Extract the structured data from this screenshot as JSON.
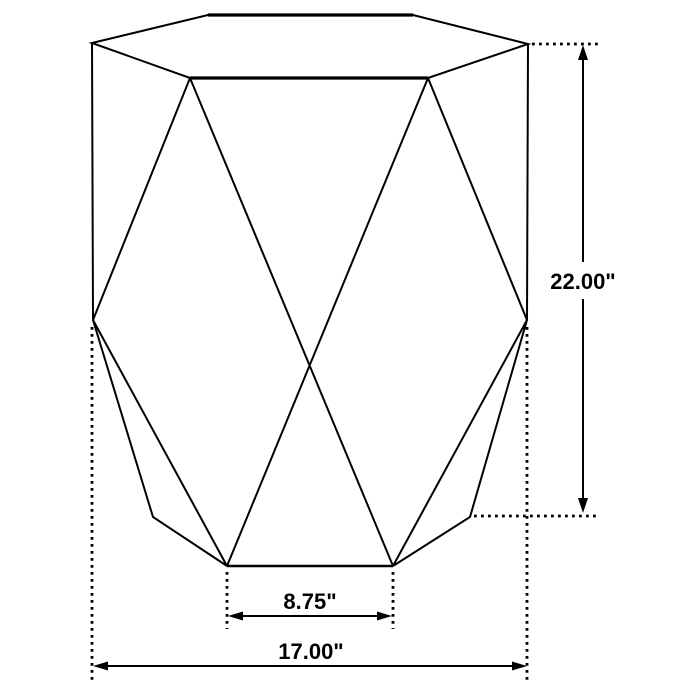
{
  "diagram": {
    "type": "furniture-dimension-drawing",
    "subject": "hexagonal faceted accent table",
    "line_color": "#000000",
    "background_color": "#ffffff",
    "dimensions": [
      {
        "id": "height",
        "label": "22.00\"",
        "orientation": "vertical"
      },
      {
        "id": "base-front-width",
        "label": "8.75\"",
        "orientation": "horizontal"
      },
      {
        "id": "overall-width",
        "label": "17.00\"",
        "orientation": "horizontal"
      }
    ]
  }
}
